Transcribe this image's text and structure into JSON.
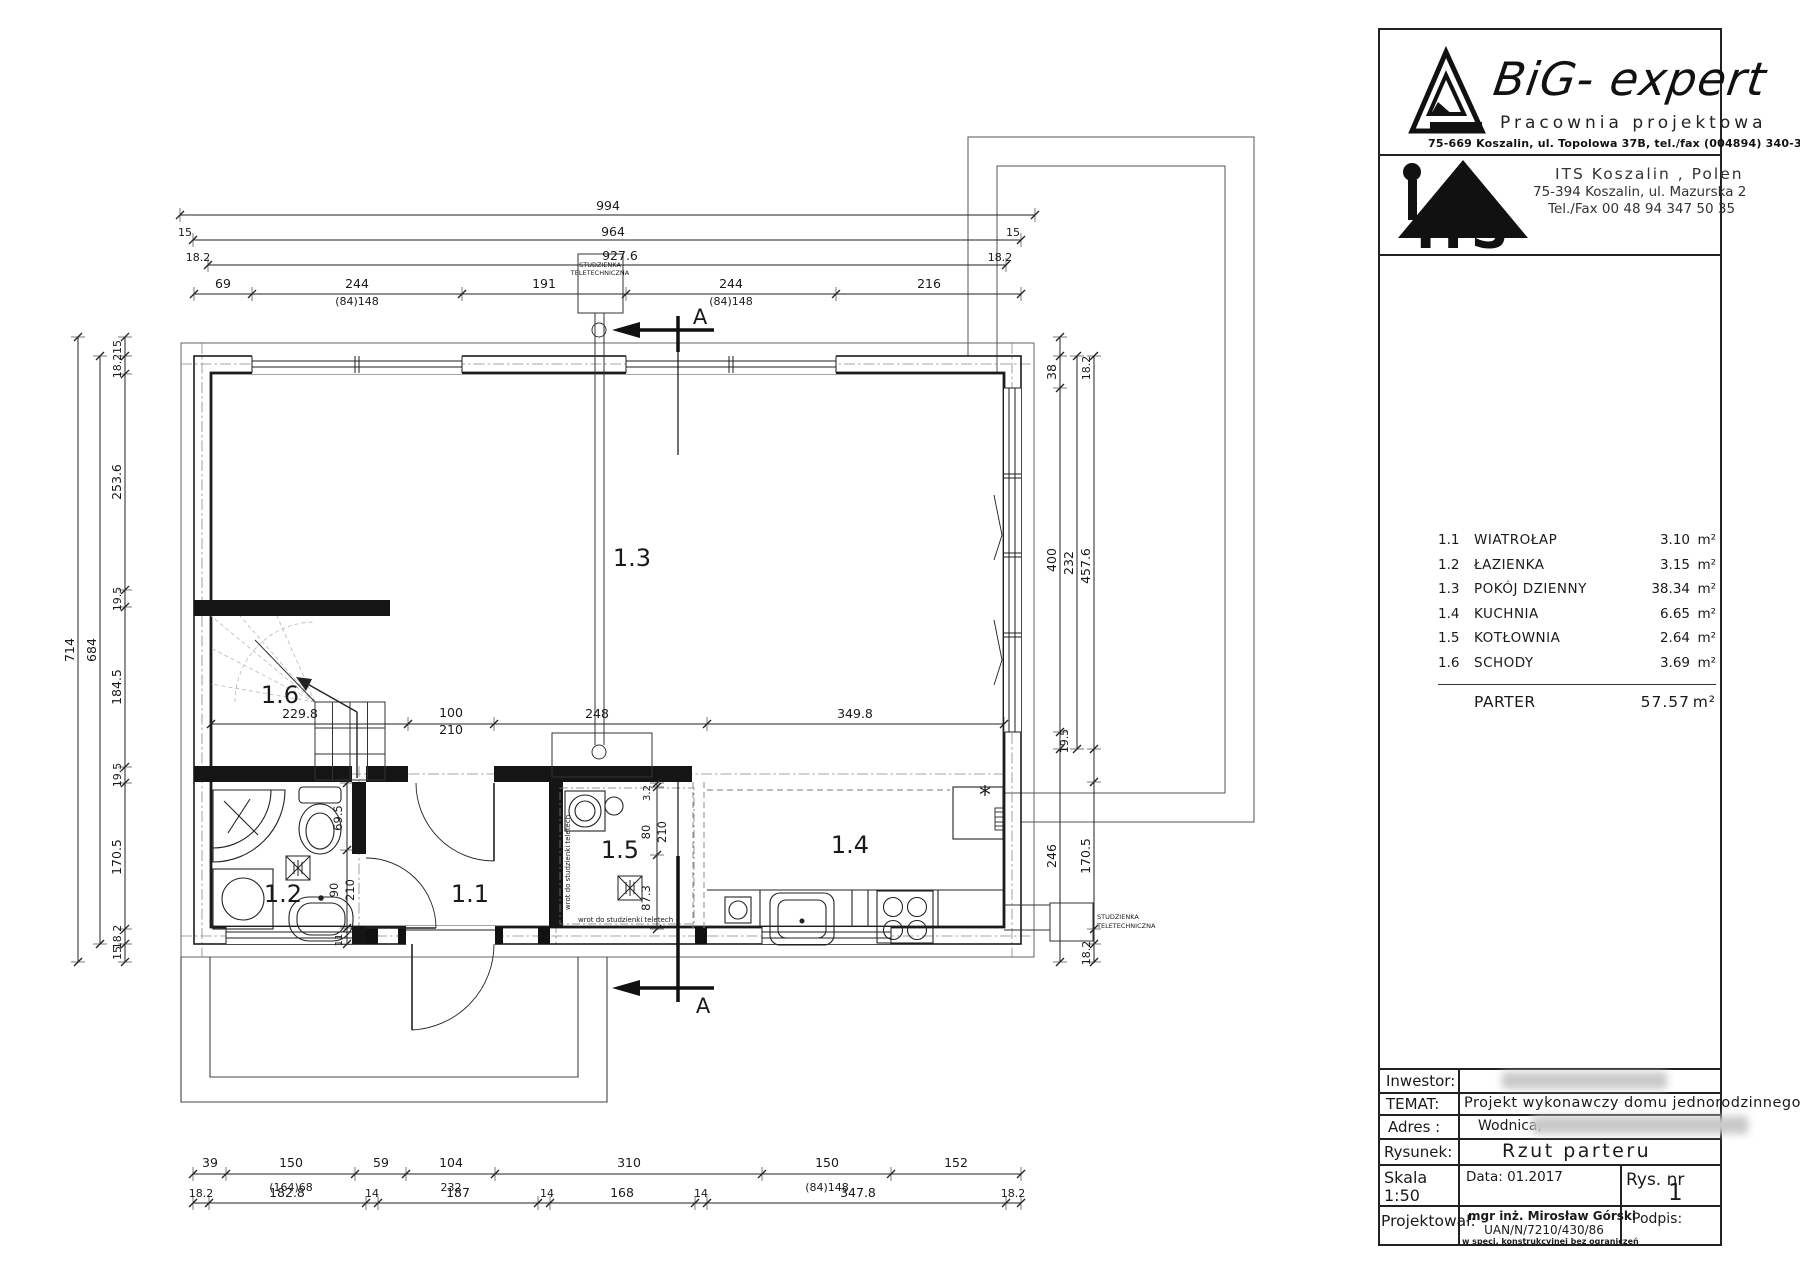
{
  "header": {
    "brand": "BiG- expert",
    "tagline": "Pracownia projektowa",
    "address": "75-669 Koszalin,   ul. Topolowa 37B,   tel./fax (004894) 340-30-76",
    "its_name": "ITS Koszalin , Polen",
    "its_addr": "75-394 Koszalin, ul. Mazurska 2",
    "its_tel": "Tel./Fax 00 48 94 347 50 35",
    "its_logo_text": "ITS"
  },
  "legend": {
    "rows": [
      {
        "no": "1.1",
        "name": "WIATROŁAP",
        "area": "3.10",
        "unit": "m²"
      },
      {
        "no": "1.2",
        "name": "ŁAZIENKA",
        "area": "3.15",
        "unit": "m²"
      },
      {
        "no": "1.3",
        "name": "POKÓJ DZIENNY",
        "area": "38.34",
        "unit": "m²"
      },
      {
        "no": "1.4",
        "name": "KUCHNIA",
        "area": "6.65",
        "unit": "m²"
      },
      {
        "no": "1.5",
        "name": "KOTŁOWNIA",
        "area": "2.64",
        "unit": "m²"
      },
      {
        "no": "1.6",
        "name": "SCHODY",
        "area": "3.69",
        "unit": "m²"
      }
    ],
    "total_label": "PARTER",
    "total_area": "57.57",
    "unit": "m²"
  },
  "title_block": {
    "inwestor_label": "Inwestor:",
    "temat_label": "TEMAT:",
    "temat": "Projekt wykonawczy domu jednorodzinnego",
    "adres_label": "Adres :",
    "adres": "Wodnica,",
    "rysunek_label": "Rysunek:",
    "rysunek": "Rzut parteru",
    "skala_label": "Skala",
    "skala": "1:50",
    "data": "Data:  01.2017",
    "rysnr_label": "Rys. nr",
    "rysnr": "1",
    "proj_label": "Projektował:",
    "proj_name": "mgr inż. Mirosław Górski",
    "proj_upr": "UAN/N/7210/430/86",
    "proj_spec": "w specj. konstrukcyjnej bez ograniczeń",
    "podpis_label": "Podpis:"
  },
  "plan": {
    "rooms": [
      {
        "t": "1.1",
        "x": 470,
        "y": 902
      },
      {
        "t": "1.2",
        "x": 283,
        "y": 902
      },
      {
        "t": "1.3",
        "x": 632,
        "y": 566
      },
      {
        "t": "1.4",
        "x": 850,
        "y": 853
      },
      {
        "t": "1.5",
        "x": 620,
        "y": 858
      },
      {
        "t": "1.6",
        "x": 280,
        "y": 703
      }
    ],
    "dim_labels": [
      {
        "t": "994",
        "x": 608,
        "y": 210
      },
      {
        "t": "964",
        "x": 613,
        "y": 236
      },
      {
        "t": "927.6",
        "x": 620,
        "y": 260
      },
      {
        "t": "15",
        "x": 185,
        "y": 236,
        "s": 11
      },
      {
        "t": "18.2",
        "x": 198,
        "y": 261,
        "s": 11
      },
      {
        "t": "15",
        "x": 1013,
        "y": 236,
        "s": 11
      },
      {
        "t": "18.2",
        "x": 1000,
        "y": 261,
        "s": 11
      },
      {
        "t": "69",
        "x": 223,
        "y": 288
      },
      {
        "t": "244",
        "x": 357,
        "y": 288
      },
      {
        "t": "(84)148",
        "x": 357,
        "y": 305,
        "s": 11
      },
      {
        "t": "191",
        "x": 544,
        "y": 288
      },
      {
        "t": "244",
        "x": 731,
        "y": 288
      },
      {
        "t": "(84)148",
        "x": 731,
        "y": 305,
        "s": 11
      },
      {
        "t": "216",
        "x": 929,
        "y": 288
      },
      {
        "t": "229.8",
        "x": 300,
        "y": 718
      },
      {
        "t": "100",
        "x": 451,
        "y": 717
      },
      {
        "t": "210",
        "x": 451,
        "y": 734
      },
      {
        "t": "248",
        "x": 597,
        "y": 718
      },
      {
        "t": "349.8",
        "x": 855,
        "y": 718
      },
      {
        "t": "39",
        "x": 210,
        "y": 1167
      },
      {
        "t": "150",
        "x": 291,
        "y": 1167
      },
      {
        "t": "(164)68",
        "x": 291,
        "y": 1191,
        "s": 11
      },
      {
        "t": "59",
        "x": 381,
        "y": 1167
      },
      {
        "t": "104",
        "x": 451,
        "y": 1167
      },
      {
        "t": "232",
        "x": 451,
        "y": 1191,
        "s": 11
      },
      {
        "t": "310",
        "x": 629,
        "y": 1167
      },
      {
        "t": "150",
        "x": 827,
        "y": 1167
      },
      {
        "t": "(84)148",
        "x": 827,
        "y": 1191,
        "s": 11
      },
      {
        "t": "152",
        "x": 956,
        "y": 1167
      },
      {
        "t": "18.2",
        "x": 201,
        "y": 1197,
        "s": 11
      },
      {
        "t": "182.8",
        "x": 287,
        "y": 1197
      },
      {
        "t": "14",
        "x": 372,
        "y": 1197,
        "s": 11
      },
      {
        "t": "187",
        "x": 458,
        "y": 1197
      },
      {
        "t": "14",
        "x": 547,
        "y": 1197,
        "s": 11
      },
      {
        "t": "168",
        "x": 622,
        "y": 1197
      },
      {
        "t": "14",
        "x": 701,
        "y": 1197,
        "s": 11
      },
      {
        "t": "347.8",
        "x": 858,
        "y": 1197
      },
      {
        "t": "18.2",
        "x": 1013,
        "y": 1197,
        "s": 11
      },
      {
        "t": "714",
        "x": 74,
        "y": 650,
        "r": 1
      },
      {
        "t": "684",
        "x": 96,
        "y": 650,
        "r": 1
      },
      {
        "t": "15",
        "x": 121,
        "y": 347,
        "r": 1,
        "s": 11
      },
      {
        "t": "18.2",
        "x": 121,
        "y": 366,
        "r": 1,
        "s": 11
      },
      {
        "t": "253.6",
        "x": 121,
        "y": 482,
        "r": 1
      },
      {
        "t": "19.5",
        "x": 121,
        "y": 599,
        "r": 1,
        "s": 11
      },
      {
        "t": "184.5",
        "x": 121,
        "y": 687,
        "r": 1
      },
      {
        "t": "19.5",
        "x": 121,
        "y": 775,
        "r": 1,
        "s": 11
      },
      {
        "t": "170.5",
        "x": 121,
        "y": 857,
        "r": 1
      },
      {
        "t": "18.2",
        "x": 121,
        "y": 937,
        "r": 1,
        "s": 11
      },
      {
        "t": "15",
        "x": 121,
        "y": 953,
        "r": 1,
        "s": 11
      },
      {
        "t": "38",
        "x": 1056,
        "y": 372,
        "r": 1
      },
      {
        "t": "18.2",
        "x": 1090,
        "y": 368,
        "r": 1,
        "s": 11
      },
      {
        "t": "400",
        "x": 1056,
        "y": 560,
        "r": 1
      },
      {
        "t": "232",
        "x": 1073,
        "y": 563,
        "r": 1
      },
      {
        "t": "457.6",
        "x": 1090,
        "y": 566,
        "r": 1
      },
      {
        "t": "19.5",
        "x": 1068,
        "y": 741,
        "r": 1,
        "s": 11
      },
      {
        "t": "246",
        "x": 1056,
        "y": 856,
        "r": 1
      },
      {
        "t": "170.5",
        "x": 1090,
        "y": 856,
        "r": 1
      },
      {
        "t": "18.2",
        "x": 1090,
        "y": 953,
        "r": 1,
        "s": 11
      },
      {
        "t": "69.5",
        "x": 342,
        "y": 818,
        "r": 1,
        "s": 11.5
      },
      {
        "t": "90",
        "x": 338,
        "y": 890,
        "r": 1,
        "s": 11.5
      },
      {
        "t": "210",
        "x": 354,
        "y": 890,
        "r": 1,
        "s": 11.5
      },
      {
        "t": "11",
        "x": 342,
        "y": 940,
        "r": 1,
        "s": 10
      },
      {
        "t": "3.2",
        "x": 650,
        "y": 793,
        "r": 1,
        "s": 10
      },
      {
        "t": "80",
        "x": 650,
        "y": 832,
        "r": 1,
        "s": 11.5
      },
      {
        "t": "210",
        "x": 666,
        "y": 832,
        "r": 1,
        "s": 11.5
      },
      {
        "t": "87.3",
        "x": 650,
        "y": 898,
        "r": 1,
        "s": 11.5
      }
    ],
    "annotations": [
      {
        "t": "STUDZIENKA",
        "x": 600,
        "y": 267,
        "s": 6.5
      },
      {
        "t": "TELETECHNICZNA",
        "x": 600,
        "y": 275,
        "s": 6.5
      },
      {
        "t": "STUDZIENKA",
        "x": 1097,
        "y": 919,
        "s": 6.5,
        "a": "s"
      },
      {
        "t": "TELETECHNICZNA",
        "x": 1097,
        "y": 928,
        "s": 6.5,
        "a": "s"
      },
      {
        "t": "wrot do studzienki teletech",
        "x": 578,
        "y": 922,
        "s": 7,
        "a": "s"
      },
      {
        "t": "wrot do studzienki teletech",
        "x": 570,
        "y": 910,
        "s": 7,
        "r": 1,
        "a": "s"
      },
      {
        "t": "A",
        "x": 700,
        "y": 324,
        "s": 21
      },
      {
        "t": "A",
        "x": 703,
        "y": 1013,
        "s": 21
      }
    ]
  }
}
